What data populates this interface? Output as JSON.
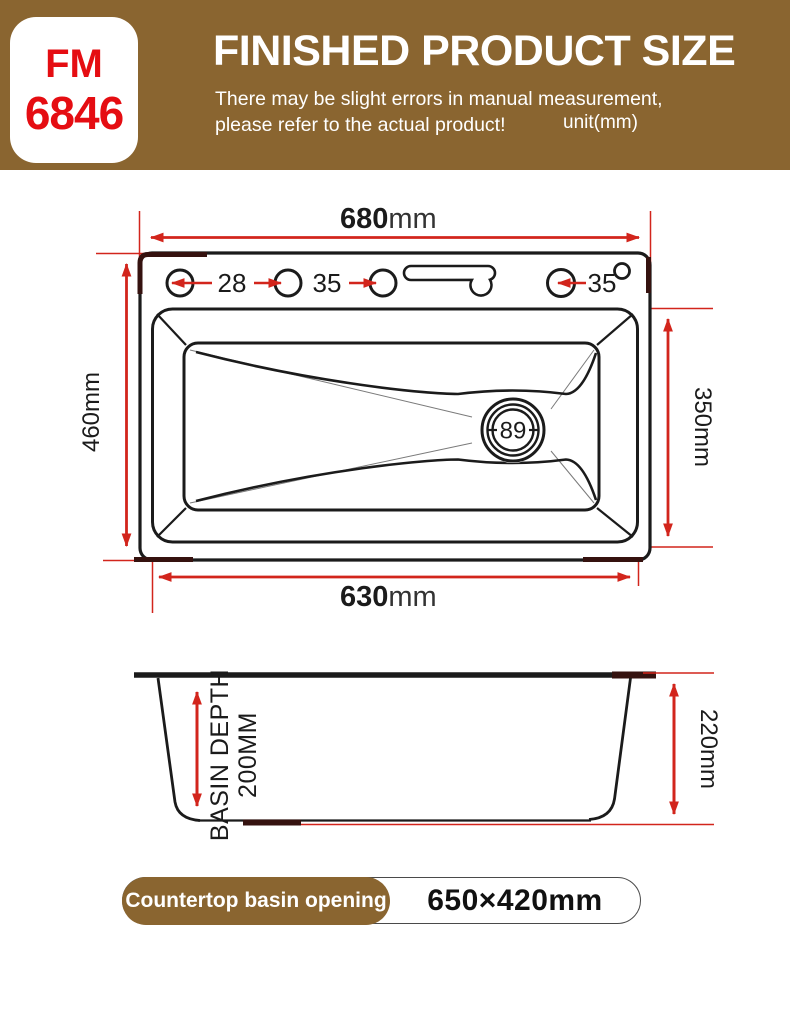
{
  "header": {
    "model_top": "FM",
    "model_bottom": "6846",
    "title": "FINISHED PRODUCT SIZE",
    "subtitle_line1": "There may be slight errors in manual measurement,",
    "subtitle_line2": "please refer to the actual product!",
    "unit_note": "unit(mm)"
  },
  "top_view": {
    "width_value": "680",
    "width_unit": "mm",
    "depth_label": "460mm",
    "bowl_height_label": "350mm",
    "bowl_width_value": "630",
    "bowl_width_unit": "mm",
    "hole_left_label": "28",
    "hole_middle_label": "35",
    "hole_right_label": "35",
    "drain_label": "89"
  },
  "side_view": {
    "basin_depth_line1": "BASIN DEPTH",
    "basin_depth_line2": "200MM",
    "overall_height_label": "220mm"
  },
  "footer": {
    "badge_label": "Countertop basin opening",
    "opening_size": "650×420mm"
  },
  "colors": {
    "banner_brown": "#8a6530",
    "dimension_red": "#d2251c",
    "model_red": "#e50d12",
    "line_ink": "#1b1b1b",
    "accent_dark": "#35120f"
  }
}
